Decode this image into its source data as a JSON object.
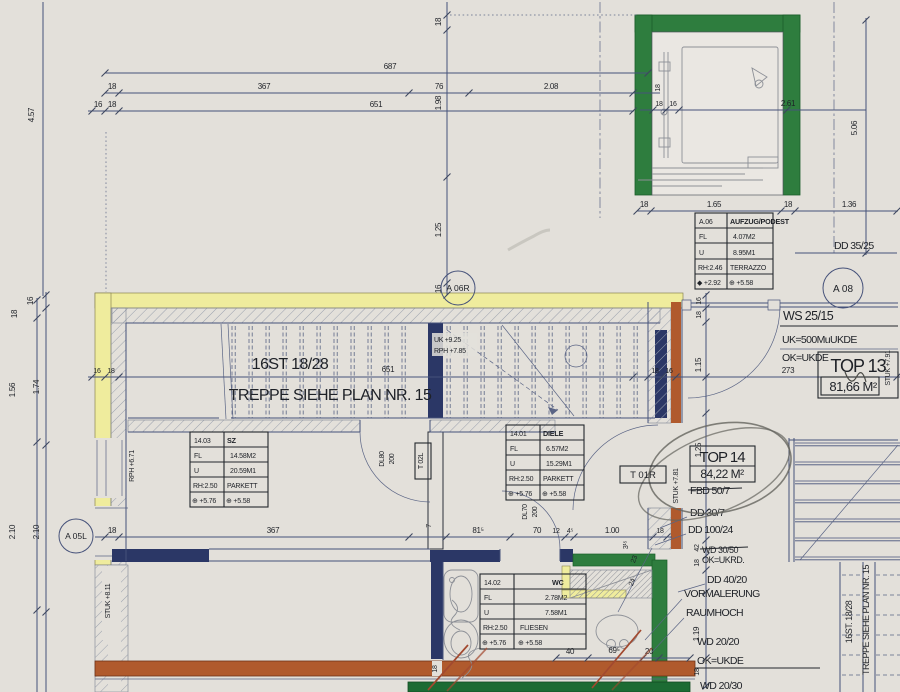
{
  "colors": {
    "paper": "#e3e0da",
    "line": "#46527a",
    "ink": "#1e2127",
    "wall_yellow": "#efec9d",
    "wall_green": "#2e7d3e",
    "wall_green_dark": "#1c6b33",
    "wall_navy": "#2b3766",
    "wall_orange": "#b05a2d",
    "redline": "#a2492f"
  },
  "rooms": {
    "a06": {
      "rows": [
        [
          "A.06",
          "AUFZUG/PODEST"
        ],
        [
          "FL",
          "4.07M2"
        ],
        [
          "U",
          "8.95M1"
        ],
        [
          "RH:2.46",
          "TERRAZZO"
        ],
        [
          "◆ +2.92",
          "⊕ +5.58"
        ]
      ]
    },
    "sz": {
      "rows": [
        [
          "14.03",
          "SZ"
        ],
        [
          "FL",
          "14.58M2"
        ],
        [
          "U",
          "20.59M1"
        ],
        [
          "RH:2.50",
          "PARKETT"
        ],
        [
          "⊕ +5.76",
          "⊕ +5.58"
        ]
      ]
    },
    "diele": {
      "rows": [
        [
          "14.01",
          "DIELE"
        ],
        [
          "FL",
          "6.57M2"
        ],
        [
          "U",
          "15.29M1"
        ],
        [
          "RH:2.50",
          "PARKETT"
        ],
        [
          "⊕ +5.76",
          "⊕ +5.58"
        ]
      ]
    },
    "wc": {
      "rows": [
        [
          "14.02",
          "WC"
        ],
        [
          "FL",
          "2.78M2"
        ],
        [
          "U",
          "7.58M1"
        ],
        [
          "RH:2.50",
          "FLIESEN"
        ],
        [
          "⊕ +5.76",
          "⊕ +5.58"
        ]
      ]
    }
  },
  "units": {
    "top13": {
      "label": "TOP 13",
      "area": "81,66 M²"
    },
    "top14": {
      "label": "TOP 14",
      "area": "84,22 M²"
    }
  },
  "stair_note": {
    "steps": "16ST  18/28",
    "ref": "TREPPE SIEHE PLAN NR. 15"
  },
  "stair_note_right": {
    "steps": "16ST. 18/28",
    "ref": "TREPPE SIEHE PLAN NR. 15"
  },
  "markers": {
    "a06r": "A 06R",
    "a08": "A 08",
    "a05l": "A 05L"
  },
  "doors": {
    "t01r": "T 01R",
    "t02l": "T 02L",
    "dl80": "DL80",
    "dl80_size": "200",
    "dl70": "DL70",
    "dl70_size": "200"
  },
  "levels": {
    "uk": "UK +9.25",
    "rph": "RPH +7.85",
    "rph_sz": "RPH +6.71",
    "stuk_left": "STUK +8.11",
    "stuk_top14": "STUK +7.81",
    "stuk_top13": "STUK +7.91"
  },
  "notes": {
    "ws": "WS 25/15",
    "uk500": "UK=500MuUKDE",
    "ok_ukde": "OK=UKDE",
    "dd3525": "DD 35/25",
    "fbd507": "FBD 50/7",
    "dd307": "DD 30/7",
    "dd10024": "DD 100/24",
    "wd3050": "WD 30/50",
    "ok_ukrd": "OK=UKRD.",
    "dd4020": "DD 40/20",
    "vormalerung": "VORMALERUNG",
    "raumhoch": "RAUMHOCH",
    "wd2020": "WD 20/20",
    "ok_ukde2": "OK=UKDE",
    "wd2030": "WD 20/30"
  },
  "dims": {
    "top": [
      "4.57",
      "687",
      "18",
      "367",
      "76",
      "2.08",
      "16",
      "18",
      "651"
    ],
    "axis": [
      "18",
      "1.98",
      "1.25",
      "16"
    ],
    "lift": [
      "18",
      "18",
      "16",
      "2.61",
      "5.06"
    ],
    "lift_row": [
      "18",
      "1.65",
      "18",
      "1.36"
    ],
    "right_up": [
      "16",
      "18",
      "1.15",
      "273",
      "18",
      "16",
      "1.25"
    ],
    "band": [
      "16",
      "18",
      "651"
    ],
    "left": [
      "18",
      "16",
      "1.56",
      "1.74",
      "2.10",
      "2.10"
    ],
    "mid": [
      "18",
      "367",
      "7",
      "81⁵",
      "70",
      "12",
      "4⁵",
      "1.00",
      "3¹⁵",
      "18"
    ],
    "right_low": [
      "42",
      "18",
      "1.19",
      "18"
    ],
    "wc": [
      "40",
      "69⁵",
      "20",
      "23",
      "24",
      "18"
    ]
  }
}
